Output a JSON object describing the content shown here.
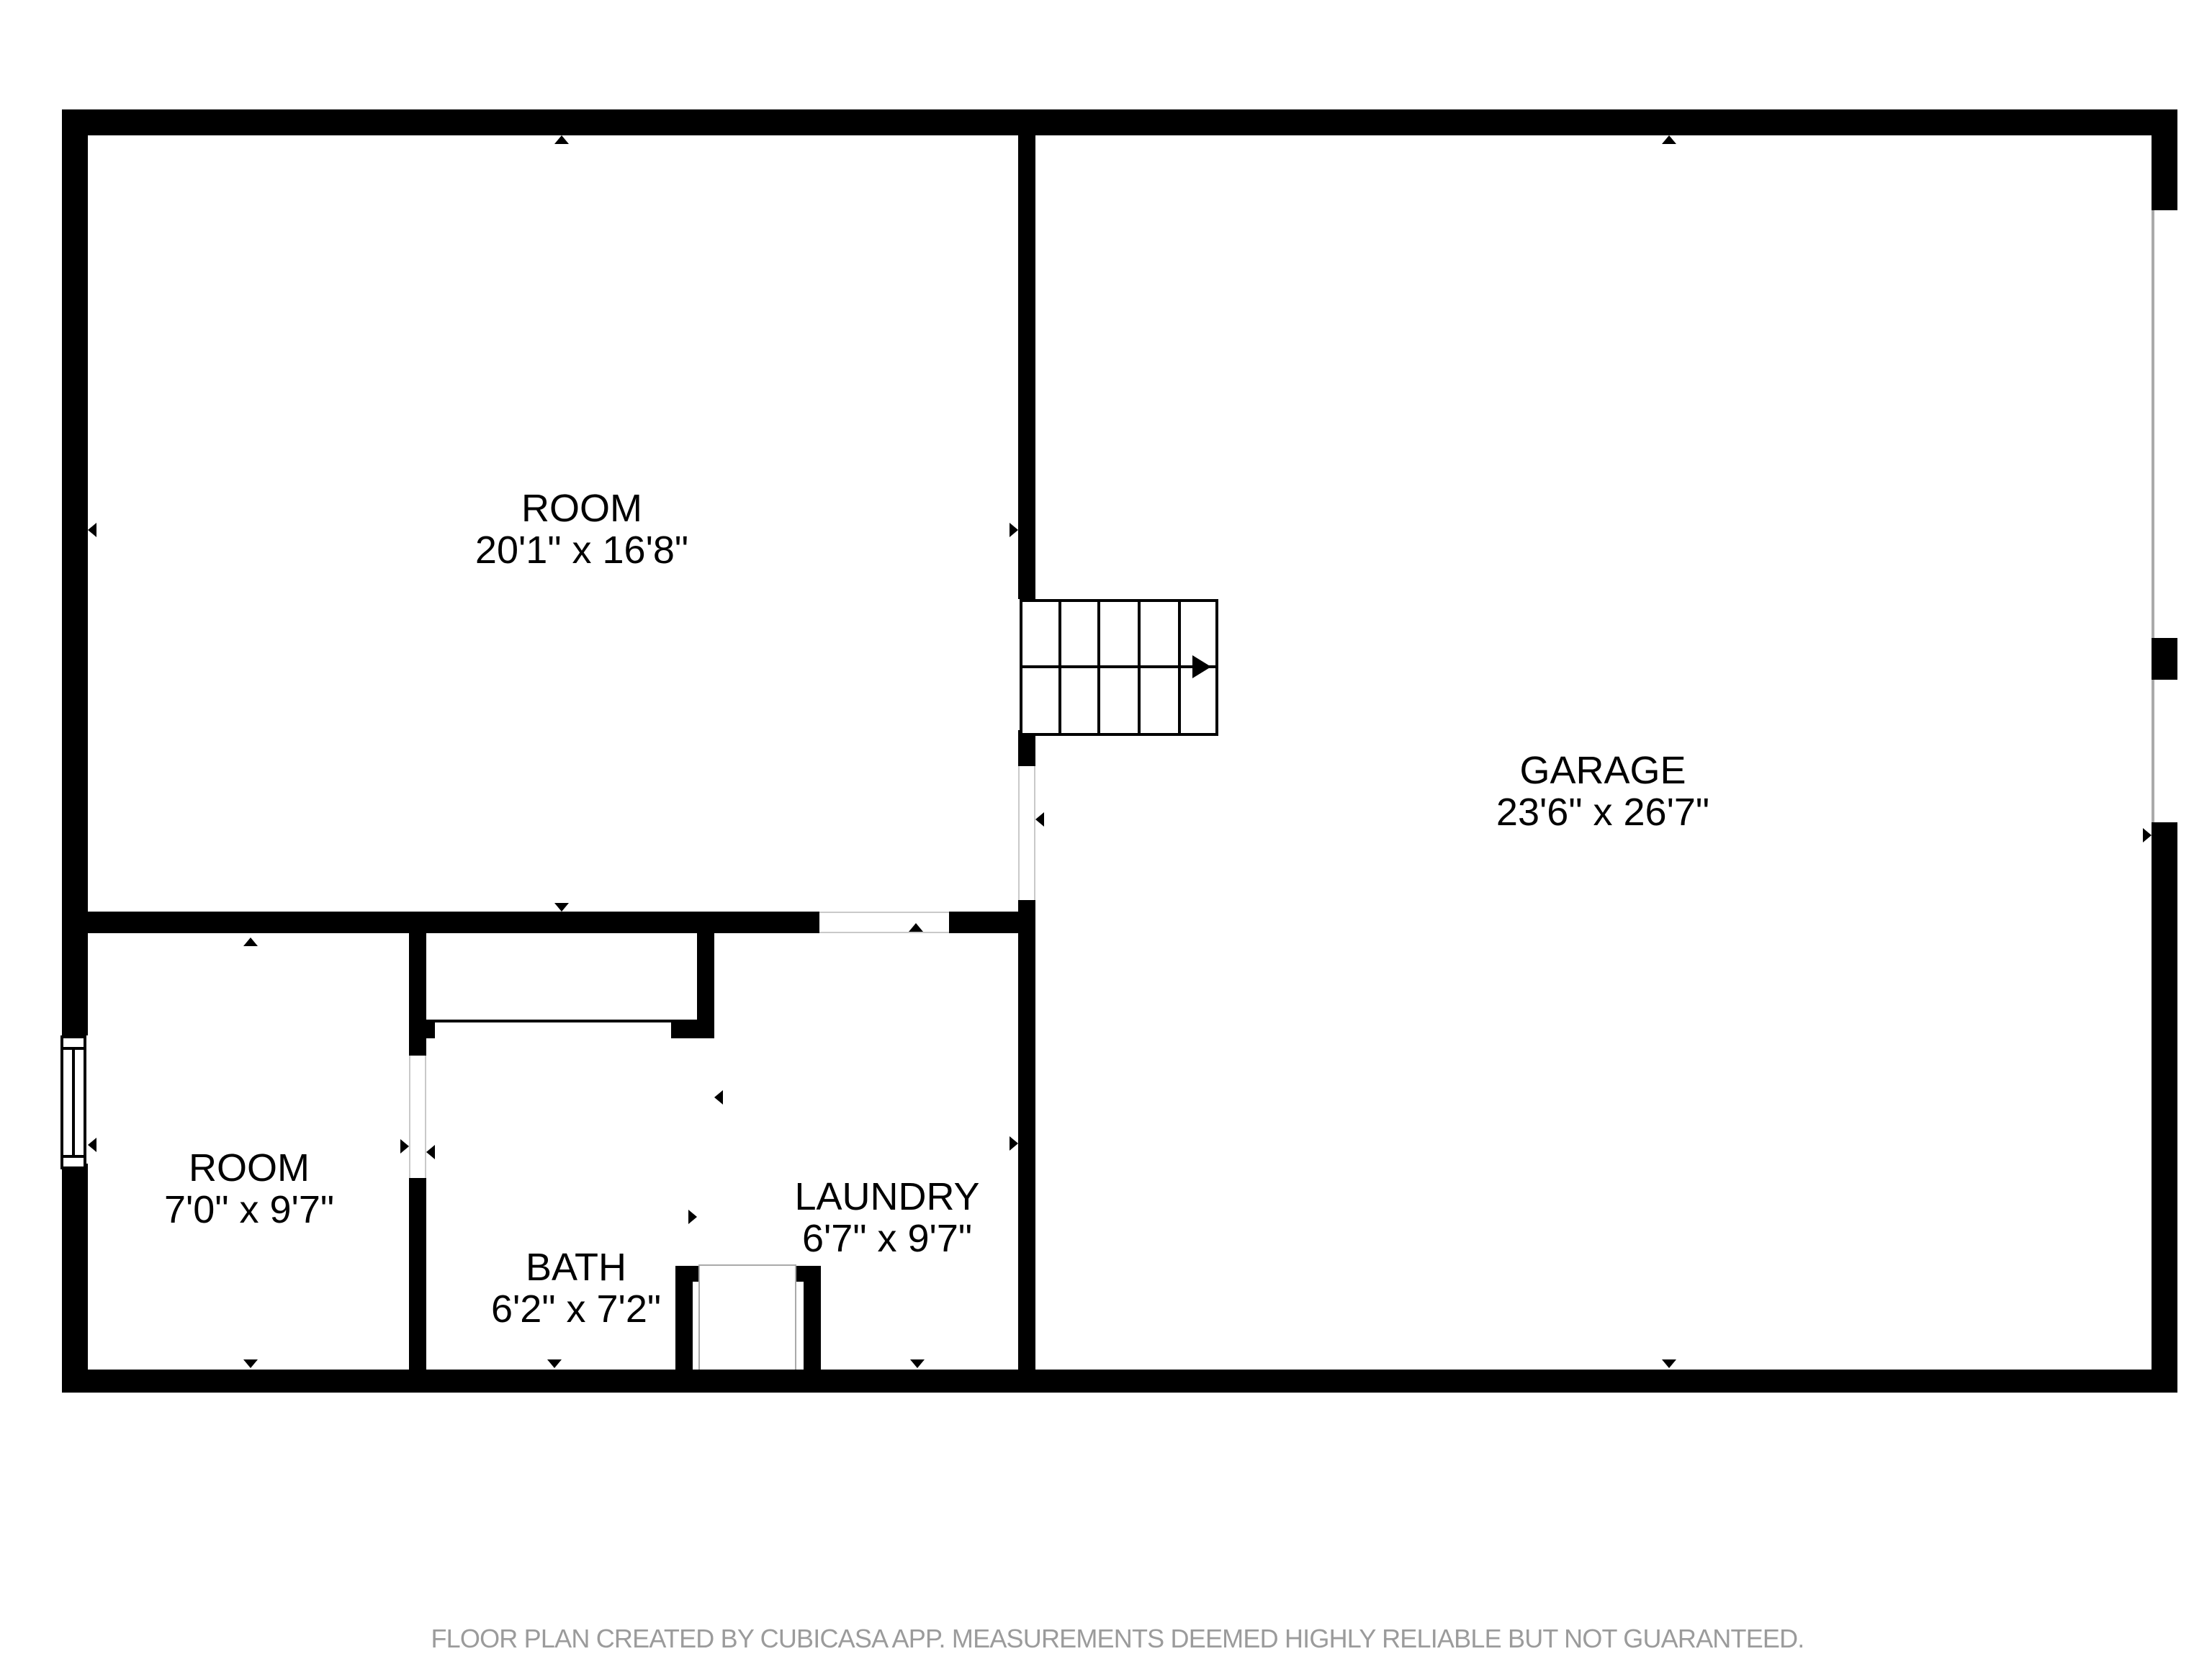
{
  "plan": {
    "rooms": [
      {
        "id": "room-top",
        "name": "ROOM",
        "dims": "20'1\" x 16'8\""
      },
      {
        "id": "garage",
        "name": "GARAGE",
        "dims": "23'6\" x 26'7\""
      },
      {
        "id": "room-bottom",
        "name": "ROOM",
        "dims": "7'0\" x 9'7\""
      },
      {
        "id": "bath",
        "name": "BATH",
        "dims": "6'2\" x 7'2\""
      },
      {
        "id": "laundry",
        "name": "LAUNDRY",
        "dims": "6'7\" x 9'7\""
      }
    ],
    "colors": {
      "wall": "#000000",
      "background": "#ffffff",
      "opening_line": "#c9c9c9",
      "footer_text": "#9b9b9b"
    }
  },
  "footer": {
    "disclaimer": "FLOOR PLAN CREATED BY CUBICASA APP. MEASUREMENTS DEEMED HIGHLY RELIABLE BUT NOT GUARANTEED."
  }
}
